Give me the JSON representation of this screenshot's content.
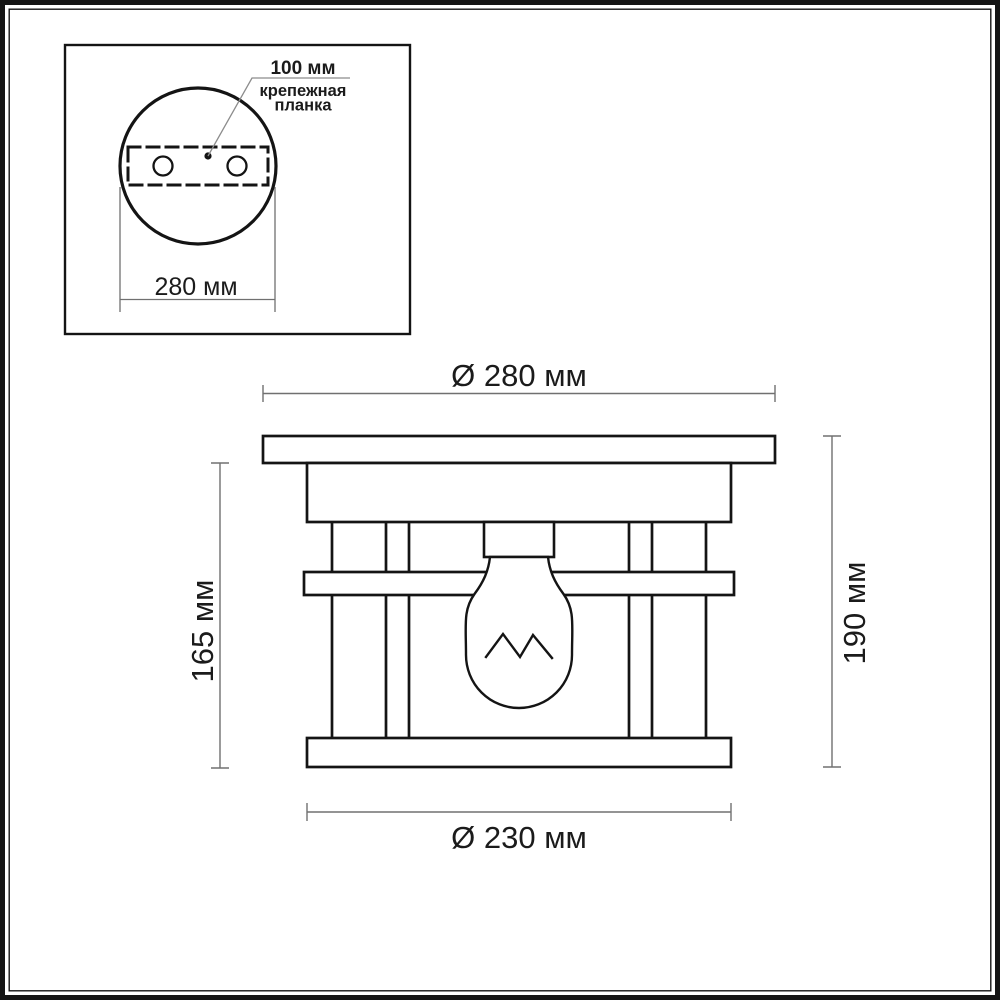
{
  "colors": {
    "drawing_line": "#141414",
    "dimension_line": "#707070",
    "leader_line": "#8c8c8c",
    "text": "#1b1b1b",
    "background": "#ffffff"
  },
  "inset_top_view": {
    "offset_label": "100 мм",
    "mount_bar_label": [
      "крепежная",
      "планка"
    ],
    "plate_diameter_label": "280 мм"
  },
  "side_view": {
    "top_diameter_label": "Ø 280 мм",
    "bottom_diameter_label": "Ø 230 мм",
    "left_height_label": "165 мм",
    "right_height_label": "190 мм"
  }
}
